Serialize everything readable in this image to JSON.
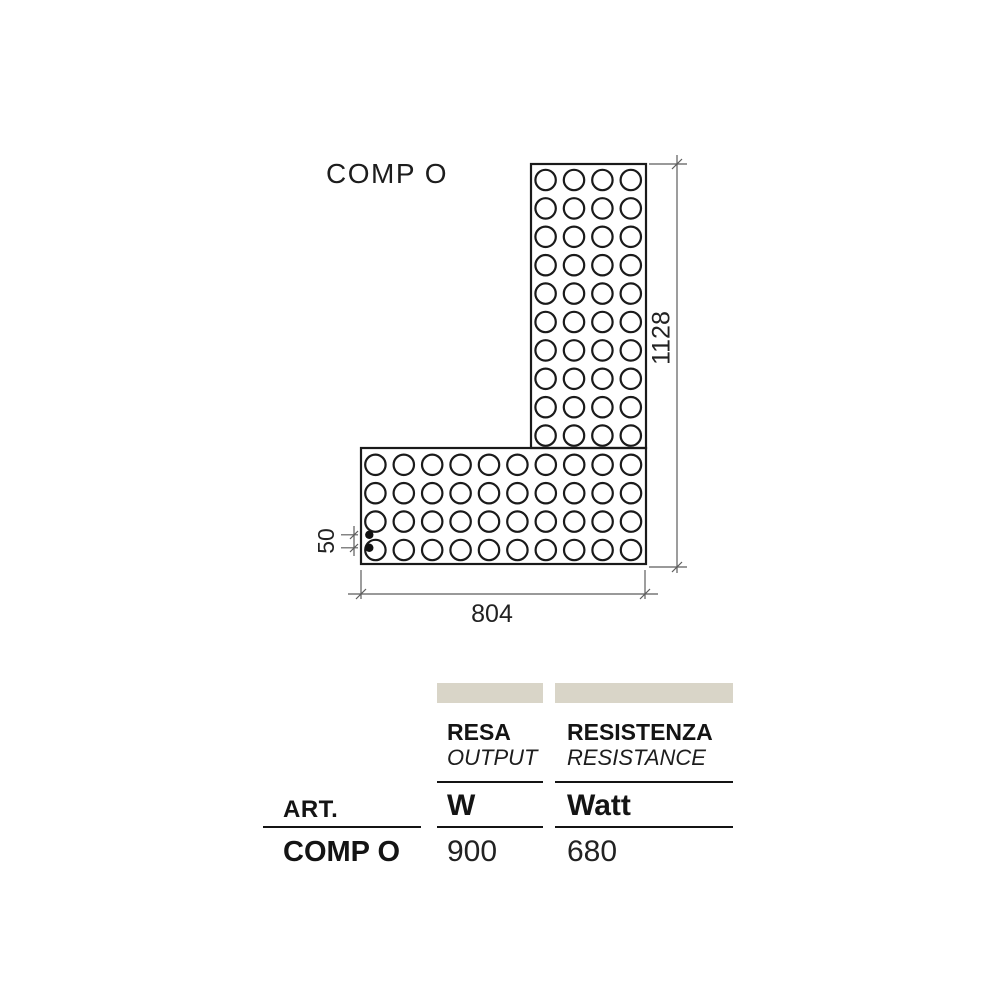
{
  "diagram": {
    "title": "COMP O",
    "dimensions": {
      "height": "1128",
      "width": "804",
      "offset": "50"
    },
    "panel": {
      "vertical_grid": {
        "cols": 4,
        "rows": 10
      },
      "horizontal_grid": {
        "cols": 10,
        "rows": 4
      },
      "connection_dots": 2
    }
  },
  "table": {
    "art_label": "ART.",
    "columns": [
      {
        "title": "RESA",
        "subtitle": "OUTPUT",
        "unit": "W"
      },
      {
        "title": "RESISTENZA",
        "subtitle": "RESISTANCE",
        "unit": "Watt"
      }
    ],
    "rows": [
      {
        "art": "COMP O",
        "values": [
          "900",
          "680"
        ]
      }
    ]
  },
  "colors": {
    "header_bar": "#d9d5c8",
    "drawing_line": "#1a1a1a",
    "dimension_line": "#5c5c5c"
  }
}
